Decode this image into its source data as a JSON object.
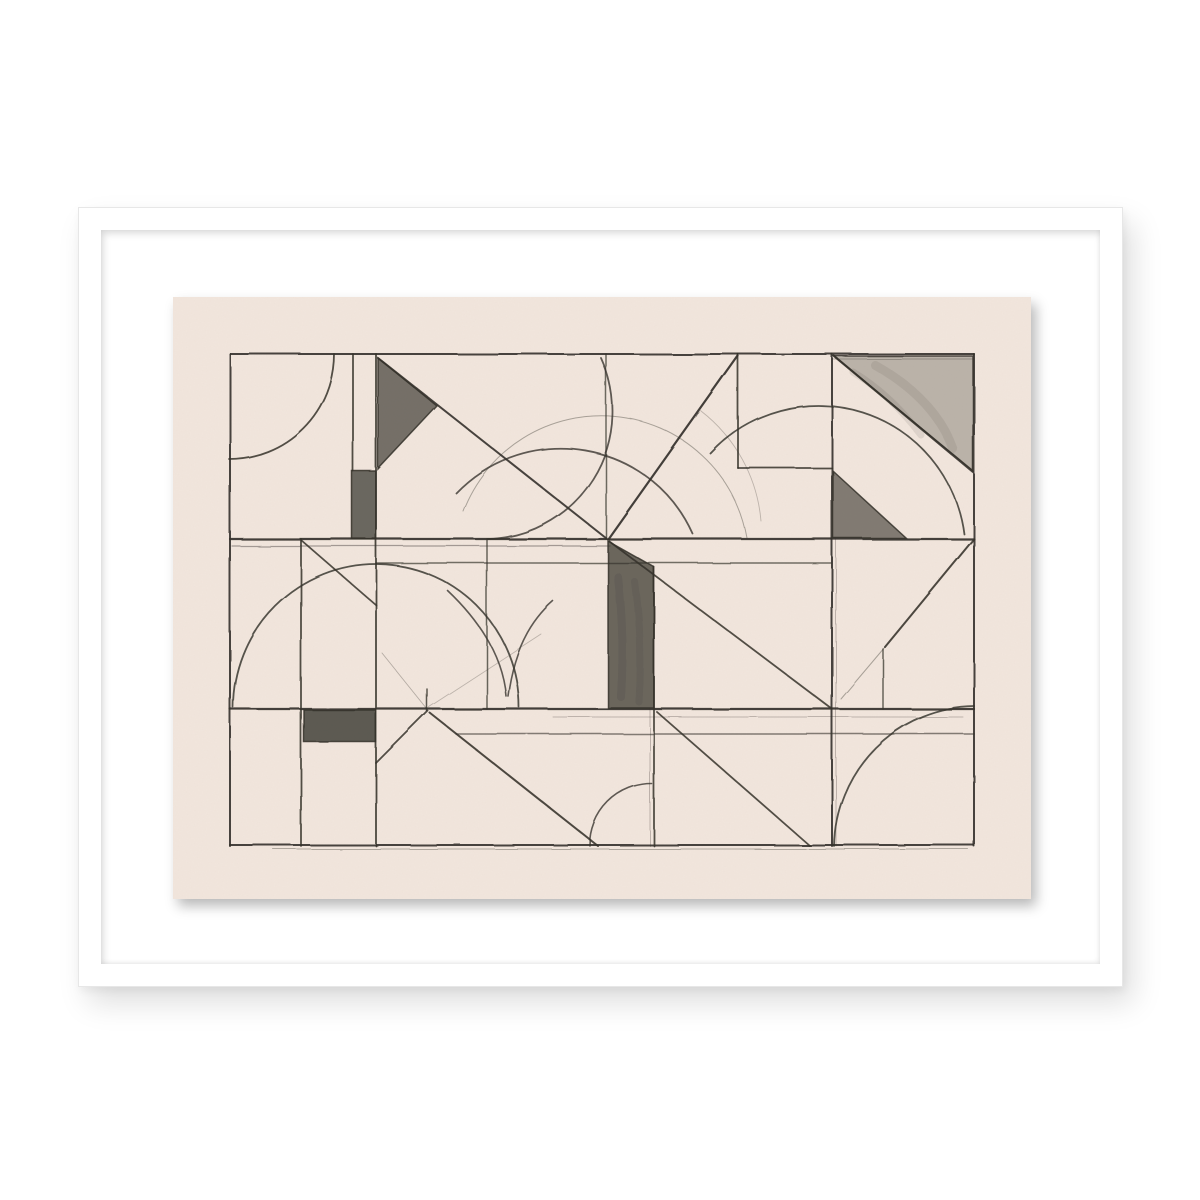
{
  "artwork": {
    "description": "Framed abstract geometric pencil drawing: ruled grid lines, diagonals, compass arcs and shaded triangles and rectangles on warm cream paper, floated on a white mat inside a thin white gallery frame",
    "style": "constructivist pencil study",
    "palette": {
      "page_background": "#ffffff",
      "frame": "#ffffff",
      "mat": "#ffffff",
      "paper": "#f2e6dd",
      "pencil": "#35322b",
      "shade_dark": "#43403a",
      "shade_soft": "#6f6b61"
    },
    "drawing": {
      "viewbox": "0 0 858 602",
      "segments": [
        [
          57,
          57,
          801,
          57,
          2,
          0.9
        ],
        [
          659,
          62,
          801,
          62,
          1,
          0.3
        ],
        [
          57,
          242,
          801,
          242,
          2.2,
          0.92
        ],
        [
          59,
          249,
          437,
          249,
          1.2,
          0.42
        ],
        [
          203,
          266,
          658,
          266,
          1.5,
          0.68
        ],
        [
          565,
          171,
          659,
          171,
          1.8,
          0.85
        ],
        [
          57,
          412,
          801,
          412,
          2.2,
          0.92
        ],
        [
          380,
          420,
          790,
          420,
          0.9,
          0.28
        ],
        [
          283,
          437,
          801,
          437,
          1.4,
          0.6
        ],
        [
          57,
          548,
          801,
          548,
          2,
          0.9
        ],
        [
          100,
          552,
          795,
          552,
          1,
          0.35
        ],
        [
          57,
          57,
          57,
          549,
          2,
          0.9
        ],
        [
          128,
          242,
          128,
          549,
          1.8,
          0.85
        ],
        [
          180,
          57,
          180,
          174,
          1.8,
          0.85
        ],
        [
          203,
          57,
          203,
          549,
          1.8,
          0.88
        ],
        [
          254,
          392,
          254,
          414,
          1.5,
          0.8
        ],
        [
          314,
          242,
          314,
          412,
          1.5,
          0.72
        ],
        [
          433,
          57,
          433,
          242,
          1.5,
          0.7
        ],
        [
          481,
          270,
          481,
          549,
          1.8,
          0.85
        ],
        [
          477,
          412,
          477,
          549,
          0.9,
          0.32
        ],
        [
          565,
          57,
          565,
          171,
          1.8,
          0.85
        ],
        [
          659,
          57,
          659,
          549,
          2,
          0.9
        ],
        [
          663,
          242,
          663,
          549,
          0.9,
          0.32
        ],
        [
          710,
          352,
          710,
          412,
          1.5,
          0.72
        ],
        [
          801,
          57,
          801,
          549,
          2,
          0.9
        ],
        [
          205,
          61,
          433,
          241,
          2,
          0.9
        ],
        [
          565,
          59,
          435,
          242,
          2.2,
          0.92
        ],
        [
          436,
          244,
          659,
          412,
          1.8,
          0.85
        ],
        [
          800,
          243,
          712,
          350,
          2,
          0.88
        ],
        [
          712,
          350,
          668,
          402,
          1,
          0.38
        ],
        [
          255,
          414,
          203,
          466,
          1.8,
          0.85
        ],
        [
          257,
          416,
          425,
          549,
          2,
          0.88
        ],
        [
          128,
          243,
          203,
          308,
          1.8,
          0.85
        ],
        [
          484,
          415,
          636,
          548,
          1.8,
          0.85
        ],
        [
          209,
          356,
          254,
          412,
          0.9,
          0.32
        ],
        [
          256,
          410,
          368,
          337,
          0.9,
          0.28
        ],
        [
          661,
          59,
          800,
          175,
          2.2,
          0.9
        ]
      ],
      "arcs": [
        [
          "M 161,57 A 105,105 0 0 1 56,162",
          1.8,
          0.85
        ],
        [
          "M 428,61 A 128,128 0 0 1 315,242",
          1.8,
          0.78
        ],
        [
          "M 283,196 A 145,145 0 0 1 520,237",
          1.8,
          0.78
        ],
        [
          "M 290,214 A 148,148 0 0 1 574,241",
          1,
          0.38
        ],
        [
          "M 537,156 A 147,147 0 0 1 791,237",
          1.8,
          0.82
        ],
        [
          "M 528,114 A 156,156 0 0 1 588,224",
          0.9,
          0.28
        ],
        [
          "M 60,410 A 143,143 0 0 1 346,410",
          1.8,
          0.82
        ],
        [
          "M 275,294 Q 328,344 333,399",
          1.6,
          0.78
        ],
        [
          "M 335,399 Q 343,336 380,304",
          1.6,
          0.78
        ],
        [
          "M 417,549 A 62,62 0 0 1 479,487",
          1.6,
          0.78
        ],
        [
          "M 661,549 A 142,142 0 0 1 801,409",
          1.8,
          0.82
        ],
        [
          "M 680,75 Q 718,98 748,138",
          7,
          0.1
        ],
        [
          "M 702,68 Q 762,102 780,152",
          9,
          0.09
        ],
        [
          "M 445,280 Q 452,340 448,400",
          8,
          0.12
        ],
        [
          "M 462,285 Q 470,345 466,405",
          7,
          0.1
        ]
      ],
      "shapes": [
        {
          "kind": "polygon",
          "pts": "205,61 264,109 205,172",
          "fill": "#45423b",
          "o": 0.72
        },
        {
          "kind": "polygon",
          "pts": "661,59 800,59 800,174",
          "fill": "#6f6b61",
          "o": 0.42
        },
        {
          "kind": "polygon",
          "pts": "660,174 733,241 660,241",
          "fill": "#45423b",
          "o": 0.65
        },
        {
          "kind": "rect",
          "x": 179,
          "y": 174,
          "w": 24,
          "h": 68,
          "fill": "#3f3c35",
          "o": 0.75
        },
        {
          "kind": "polygon",
          "pts": "435,244 481,270 481,411 435,411",
          "fill": "#45423a",
          "o": 0.78
        },
        {
          "kind": "rect",
          "x": 131,
          "y": 413,
          "w": 72,
          "h": 32,
          "fill": "#3a3731",
          "o": 0.8
        }
      ]
    }
  }
}
